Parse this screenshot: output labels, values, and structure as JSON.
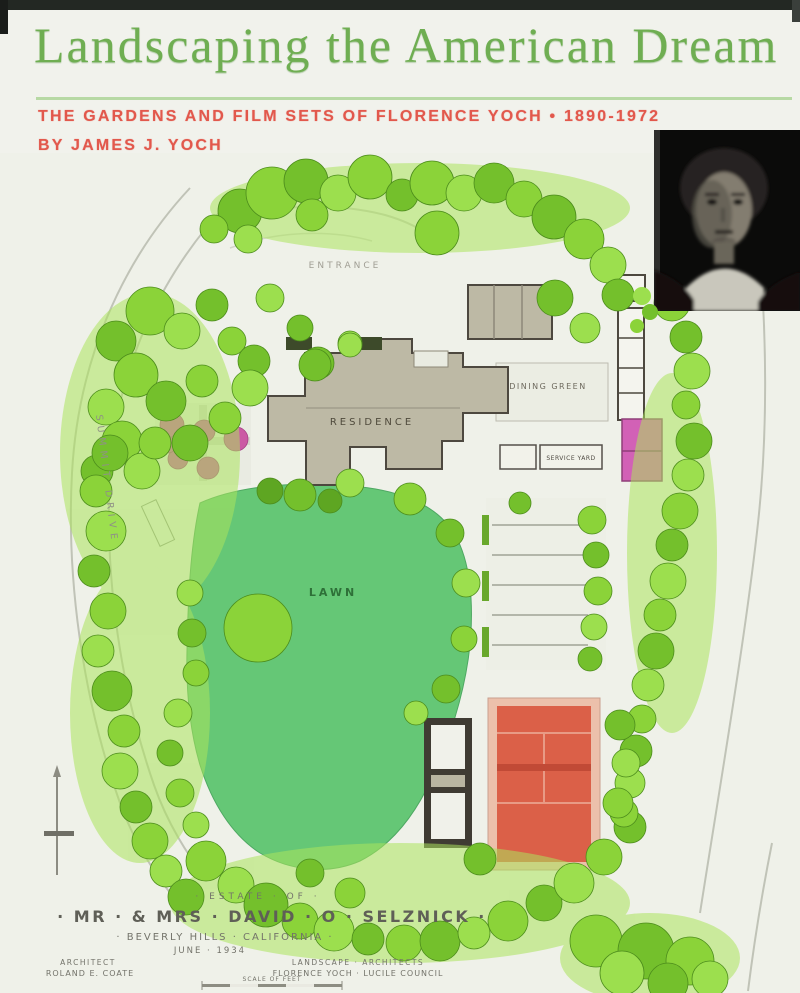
{
  "cover": {
    "title": "Landscaping the American Dream",
    "subtitle": "THE GARDENS AND FILM SETS OF FLORENCE YOCH • 1890-1972",
    "byline": "BY JAMES J. YOCH",
    "colors": {
      "title_green": "#6fae52",
      "subtitle_red": "#e2584c",
      "rule_green": "#b7d9a4",
      "lawn_green": "#65c776",
      "tennis_red": "#db6048",
      "garden_pink": "#d261b6"
    }
  },
  "plan": {
    "labels": {
      "entrance": "ENTRANCE",
      "residence": "RESIDENCE",
      "dining_green": "DINING GREEN",
      "service_yard": "SERVICE YARD",
      "lawn": "LAWN",
      "street": "SUMMIT DRIVE"
    },
    "titleblock": {
      "line1": "· ESTATE · OF ·",
      "line2": "· MR · & MRS · DAVID · O · SELZNICK ·",
      "line3": "· BEVERLY HILLS · CALIFORNIA ·",
      "line4": "JUNE · 1934",
      "credit_left_role": "ARCHITECT",
      "credit_left_name": "ROLAND E. COATE",
      "credit_right_role": "LANDSCAPE · ARCHITECTS",
      "credit_right_name": "FLORENCE YOCH · LUCILE COUNCIL",
      "scale_label": "SCALE OF FEET"
    }
  }
}
